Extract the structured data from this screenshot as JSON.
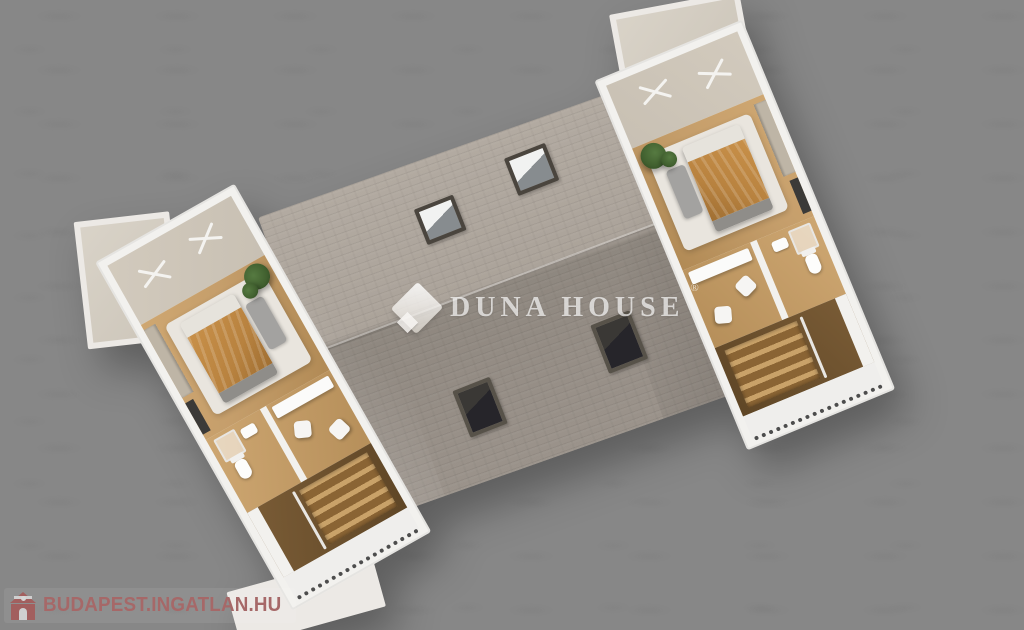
{
  "watermark": {
    "logo_icon": "duna-house-diamond-logo",
    "name": "DUNA HOUSE",
    "registered": "®"
  },
  "branding": {
    "icon": "ingatlan-hu-house-icon",
    "label": "BUDAPEST.INGATLAN.HU"
  },
  "palette": {
    "background": "#878787",
    "roof_light": "#b2aaa1",
    "roof_dark": "#968e86",
    "walls": "#f2f1ee",
    "wood_floor": "#c59e6b",
    "stair_wood": "#8a6434",
    "bed_blanket": "#b8823f",
    "terrace": "#cfc7ba",
    "plant": "#41602f",
    "skylight_frame": "#4a453e",
    "rug": "#e9e5de",
    "brand_text": "#a66868",
    "brand_icon": "#a25f5e"
  }
}
